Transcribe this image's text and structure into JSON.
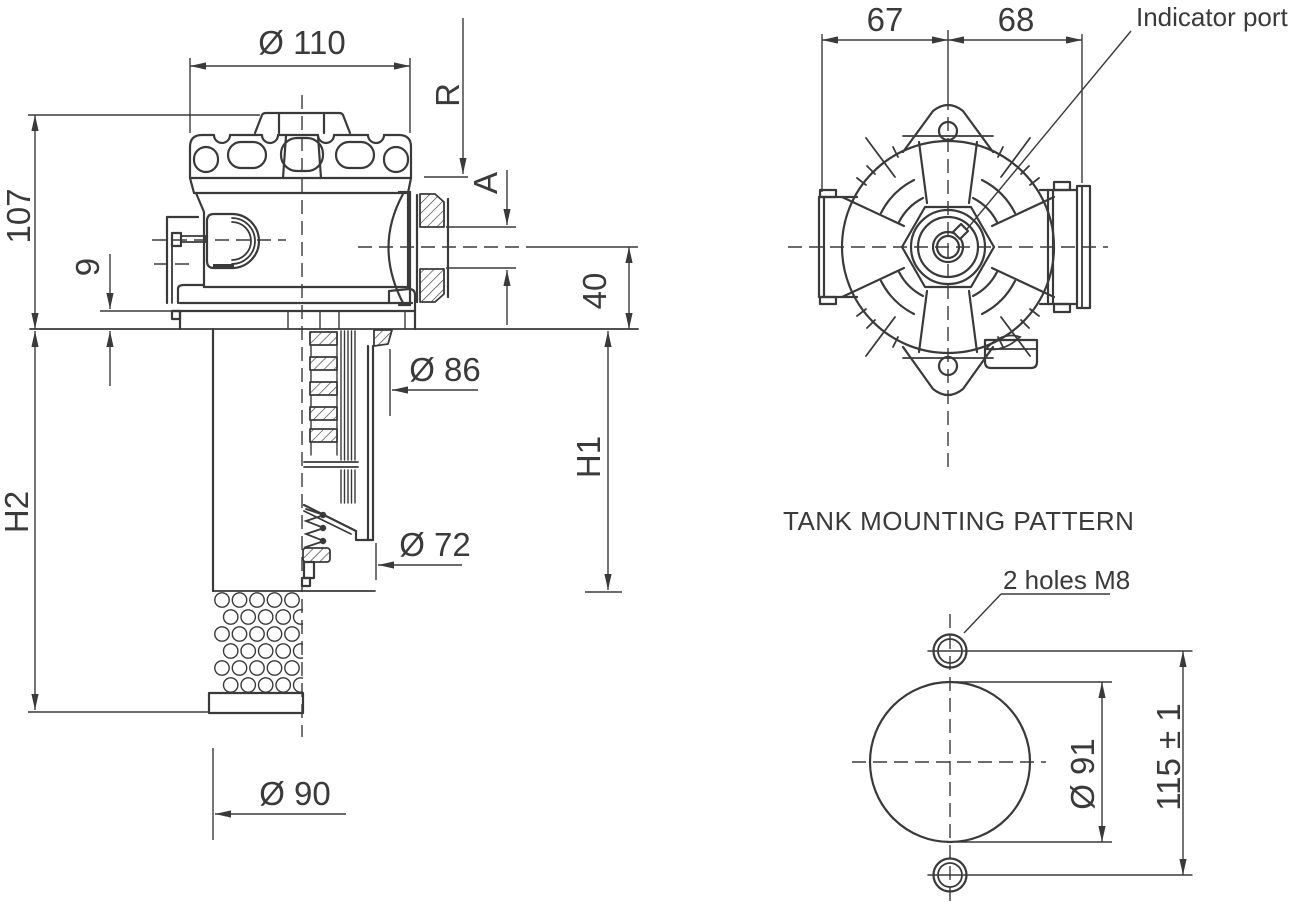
{
  "background": "#ffffff",
  "ink": "#3a3a3a",
  "side_view": {
    "dia_cap": "Ø 110",
    "return_port": "R",
    "port_thread": "A",
    "head_height": "107",
    "flange_thickness": "9",
    "port_axis_depth": "40",
    "dia_neck": "Ø 86",
    "element_height": "H1",
    "dia_element": "Ø 72",
    "total_depth": "H2",
    "dia_basket": "Ø 90"
  },
  "top_view": {
    "offset_left": "67",
    "offset_right": "68",
    "indicator_port": "Indicator port"
  },
  "mounting_pattern": {
    "title": "TANK MOUNTING PATTERN",
    "holes_note": "2 holes M8",
    "dia_cutout": "Ø 91",
    "hole_spacing": "115 ± 1"
  }
}
